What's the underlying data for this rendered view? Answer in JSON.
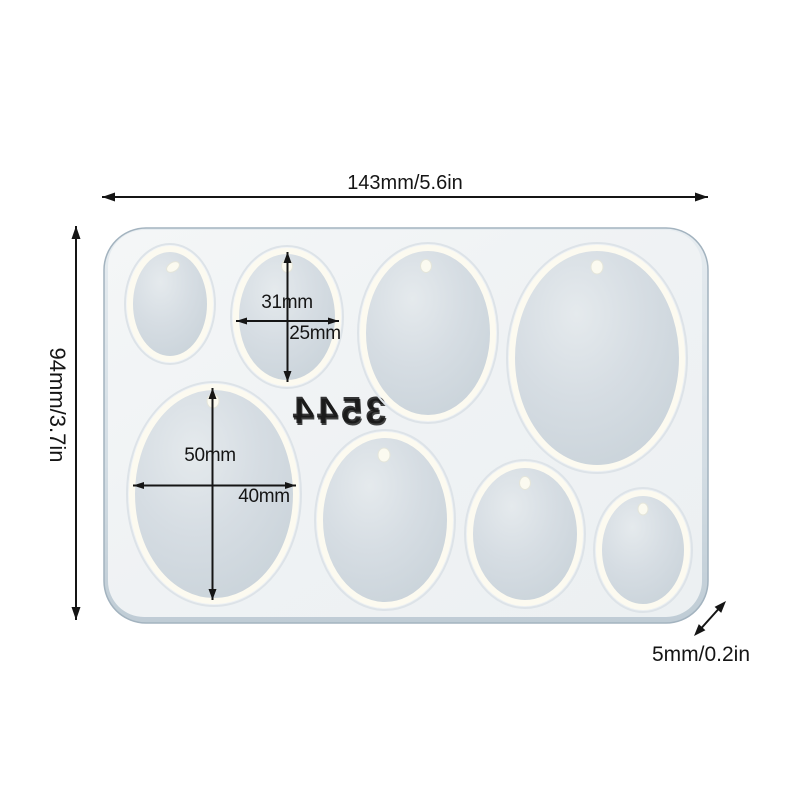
{
  "diagram": {
    "overall_width_label": "143mm/5.6in",
    "overall_height_label": "94mm/3.7in",
    "thickness_label": "5mm/0.2in",
    "medium_cavity_height_label": "31mm",
    "medium_cavity_width_label": "25mm",
    "large_cavity_height_label": "50mm",
    "large_cavity_width_label": "40mm",
    "mold_watermark": "3544",
    "cavity_count": 8
  },
  "colors": {
    "background": "#ffffff",
    "annotation": "#151515",
    "mold_surface": "#f1f4f6",
    "mold_wall": "#c9d4dc",
    "mold_edge": "#a3b3bf",
    "cavity_fill": "#cfd8de",
    "cavity_rim": "#fcfaf0"
  }
}
